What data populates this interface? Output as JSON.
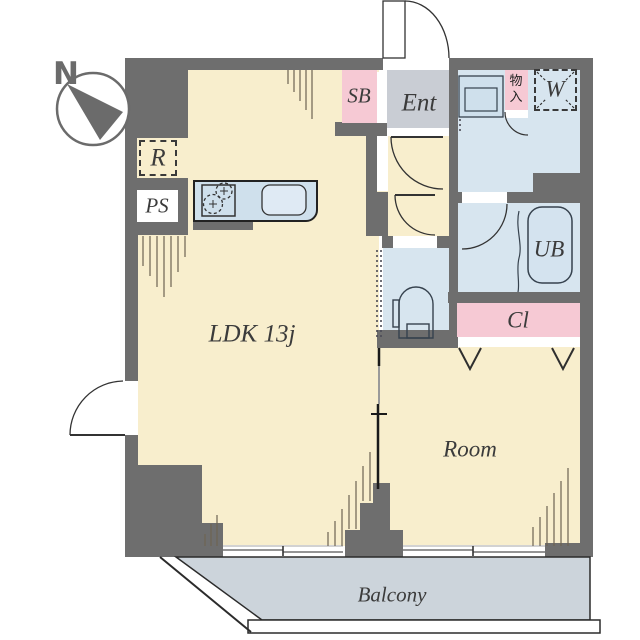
{
  "title": "Apartment floor plan",
  "compass": {
    "north_label": "N"
  },
  "rooms": {
    "ldk": {
      "label": "LDK 13j"
    },
    "bedroom": {
      "label": "Room"
    },
    "balcony": {
      "label": "Balcony"
    },
    "entrance": {
      "label": "Ent"
    },
    "shoe_box": {
      "label": "SB"
    },
    "refrigerator_space": {
      "label": "R"
    },
    "pipe_space": {
      "label": "PS"
    },
    "unit_bath": {
      "label": "UB"
    },
    "closet": {
      "label": "Cl"
    },
    "storage": {
      "label": "物入"
    },
    "washer_space": {
      "label": "W"
    }
  },
  "icons": [
    "compass-icon",
    "stove-icon",
    "kitchen-sink-icon",
    "washbasin-icon",
    "toilet-icon",
    "bathtub-icon",
    "door-swing-icon",
    "folding-door-icon",
    "sliding-door-icon"
  ],
  "colors": {
    "wall": "#6e6e6e",
    "room_cream": "#f8eecd",
    "wet_area_blue": "#d7e5ef",
    "counter_blue": "#cfe0ec",
    "pink": "#f6c9d4",
    "entrance_gray": "#c9cdd4",
    "balcony_gray": "#ccd4db",
    "line_dark": "#333333",
    "hatch_line": "#6d6352"
  }
}
